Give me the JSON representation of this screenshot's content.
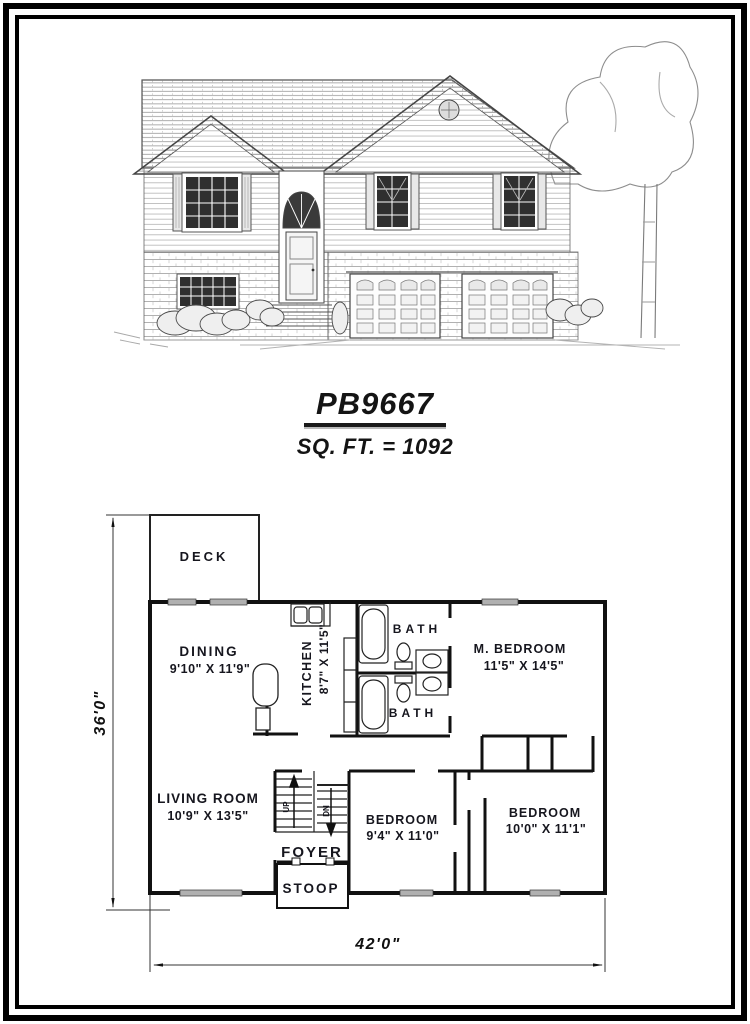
{
  "title_block": {
    "plan_number": "PB9667",
    "sqft": "SQ. FT. = 1092"
  },
  "floorplan": {
    "deck": "DECK",
    "dining_name": "DINING",
    "dining_dims": "9'10\" X 11'9\"",
    "kitchen_name": "KITCHEN",
    "kitchen_dims": "8'7\" X 11'5\"",
    "bath_top": "BATH",
    "bath_bottom": "BATH",
    "master_name": "M. BEDROOM",
    "master_dims": "11'5\" X 14'5\"",
    "living_name": "LIVING ROOM",
    "living_dims": "10'9\" X 13'5\"",
    "foyer": "FOYER",
    "stoop": "STOOP",
    "bedroom_center_name": "BEDROOM",
    "bedroom_center_dims": "9'4\" X 11'0\"",
    "bedroom_right_name": "BEDROOM",
    "bedroom_right_dims": "10'0\" X 11'1\"",
    "stair_up": "UP",
    "stair_down": "DN",
    "overall_depth": "36'0\"",
    "overall_width": "42'0\""
  },
  "colors": {
    "ink": "#1a1a1a",
    "pencil": "#6b6b6b",
    "wall": "#111111",
    "window_fill": "#2f2f2f"
  }
}
